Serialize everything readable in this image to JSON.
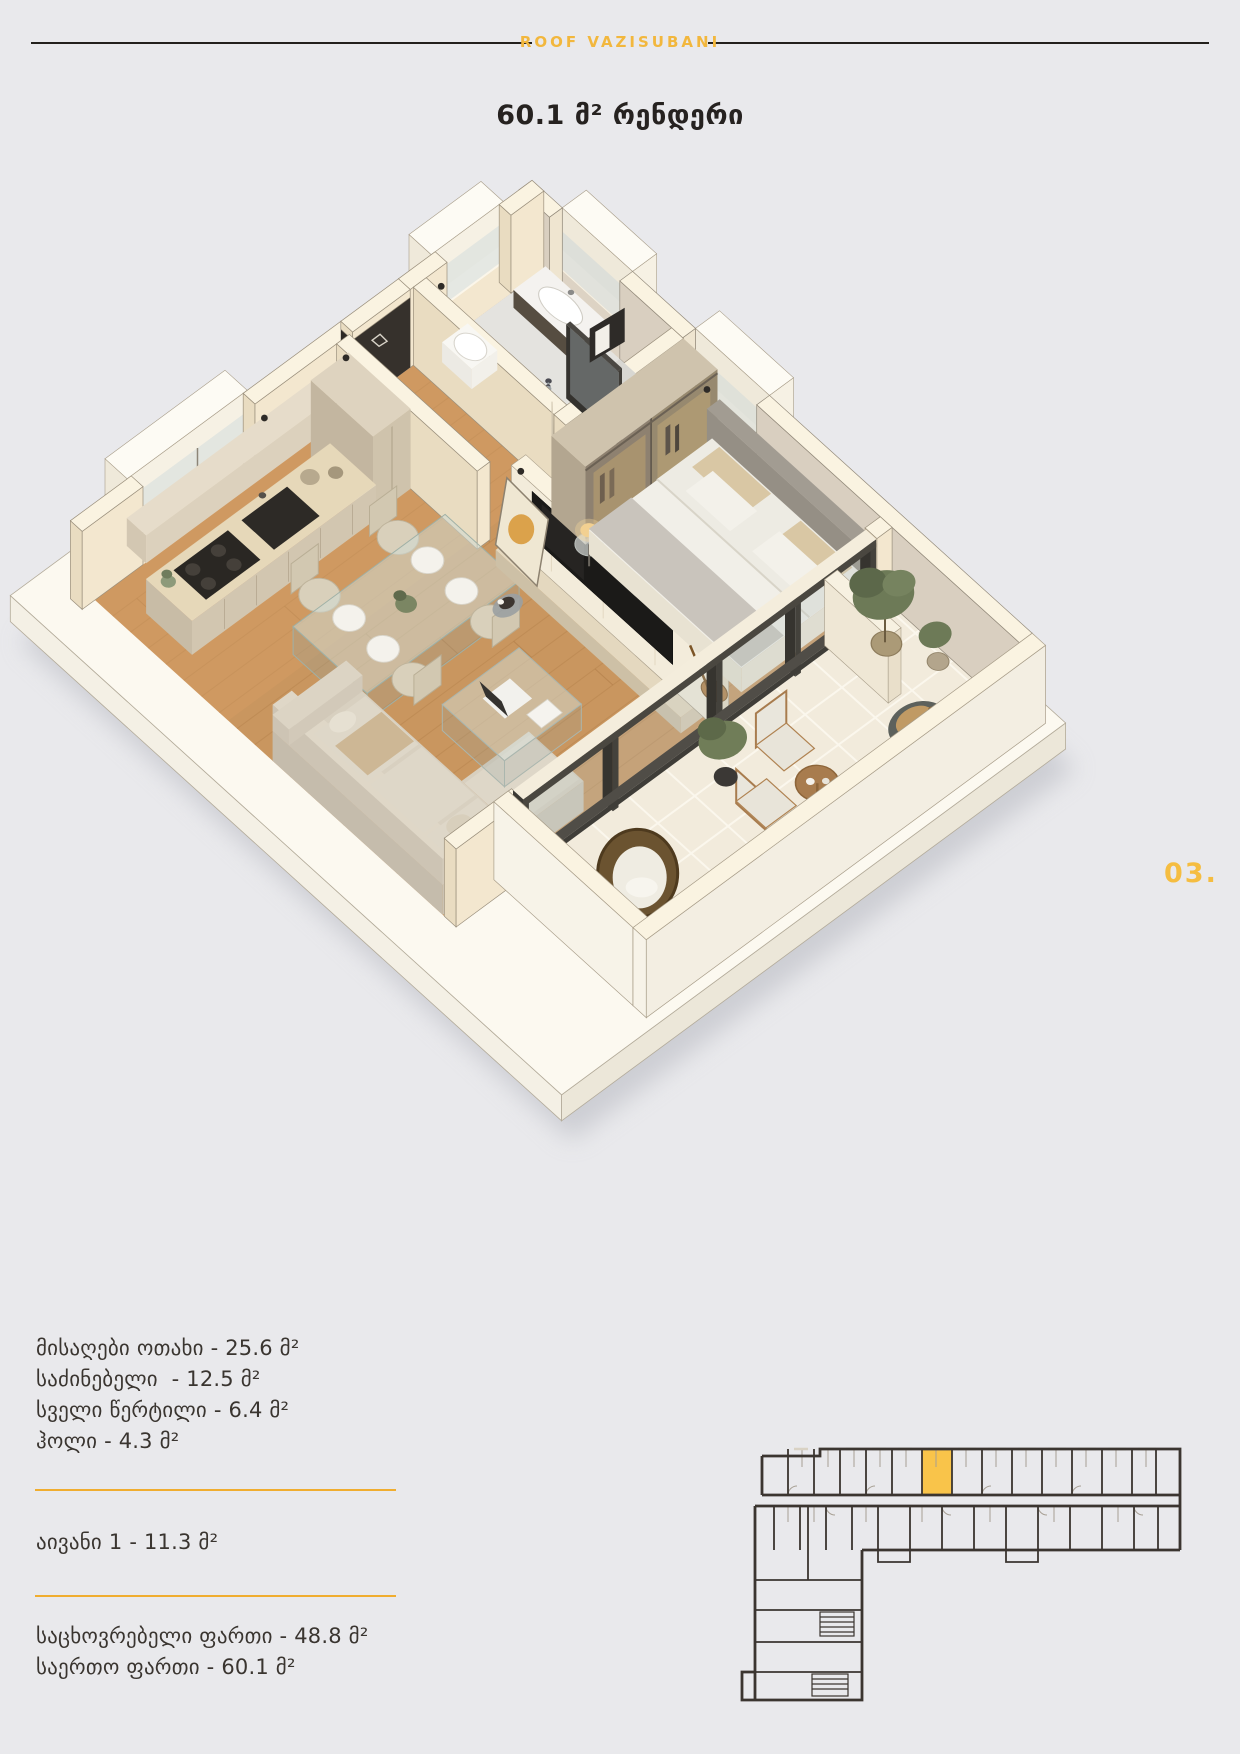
{
  "page": {
    "background_color": "#e9e9ec",
    "page_number": "03."
  },
  "header": {
    "brand": "ROOF VAZISUBANI"
  },
  "title": "60.1 მ² რენდერი",
  "areas": {
    "rooms": [
      "მისაღები ოთახი - 25.6 მ²",
      "საძინებელი  - 12.5 მ²",
      "სველი წერტილი - 6.4 მ²",
      "ჰოლი - 4.3 მ²"
    ],
    "balcony": [
      "აივანი 1 - 11.3 მ²"
    ],
    "totals": [
      "საცხოვრებელი ფართი - 48.8 მ²",
      "საერთო ფართი - 60.1 მ²"
    ]
  },
  "floorplan": {
    "highlight_color": "#f9c44a",
    "highlighted_unit": "60.1 მ² apartment"
  },
  "colors": {
    "accent_yellow": "#f2b73d",
    "divider_yellow": "#f0ad2f",
    "text_dark": "#3a3530",
    "wood_floor": "#c9965f",
    "wall_cream": "#f5ebd6",
    "plan_lines": "#3b3530"
  }
}
